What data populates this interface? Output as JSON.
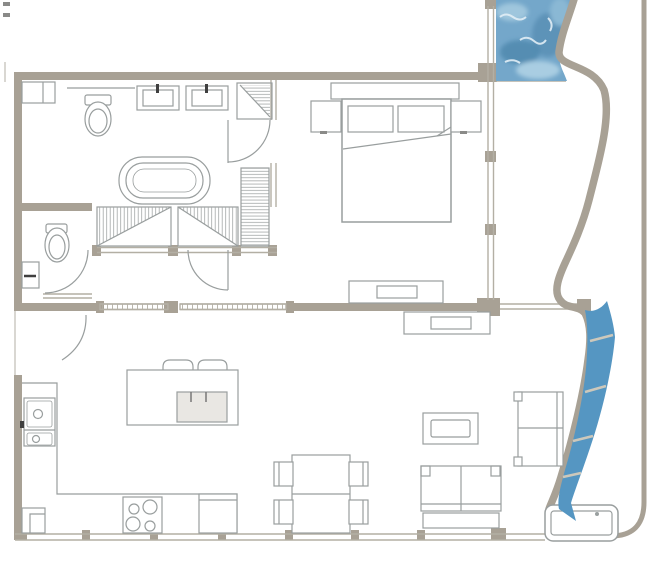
{
  "canvas": {
    "width": 667,
    "height": 576,
    "background": "#ffffff"
  },
  "palette": {
    "wall": "#a8a195",
    "window_line": "#b3afa4",
    "furniture_line": "#999e9e",
    "dark_accent": "#3f3f3f",
    "pool_base": "#74a7ca",
    "pool_dark": "#5d93b8",
    "pool_mid": "#4f88ae",
    "pool_light": "#a9cde2",
    "pool_highlight": "#e2eef6",
    "stream": "#5596c2",
    "bridge_dash": "#cdc8bb",
    "appliance_fill": "#e9e7e3",
    "fixture_fill": "#ffffff"
  },
  "plan": {
    "type": "apartment-floor-plan",
    "elements": [
      "pool",
      "water-stream",
      "plunge-tub",
      "curved-wall",
      "outer-wall",
      "double-bed",
      "pillows",
      "headboard",
      "nightstand",
      "dresser",
      "media-console",
      "wardrobe",
      "linen-closet",
      "bathtub",
      "shower",
      "vanity-double-sink",
      "toilet",
      "powder-toilet",
      "powder-sink",
      "coffee-table",
      "armchair",
      "sofa",
      "kitchen-island",
      "bar-stool",
      "island-sink",
      "kitchen-sink",
      "cooktop",
      "dishwasher",
      "kitchen-counter",
      "dining-table",
      "dining-chair",
      "entry-door",
      "interior-door",
      "sliding-door",
      "window-wall"
    ]
  }
}
